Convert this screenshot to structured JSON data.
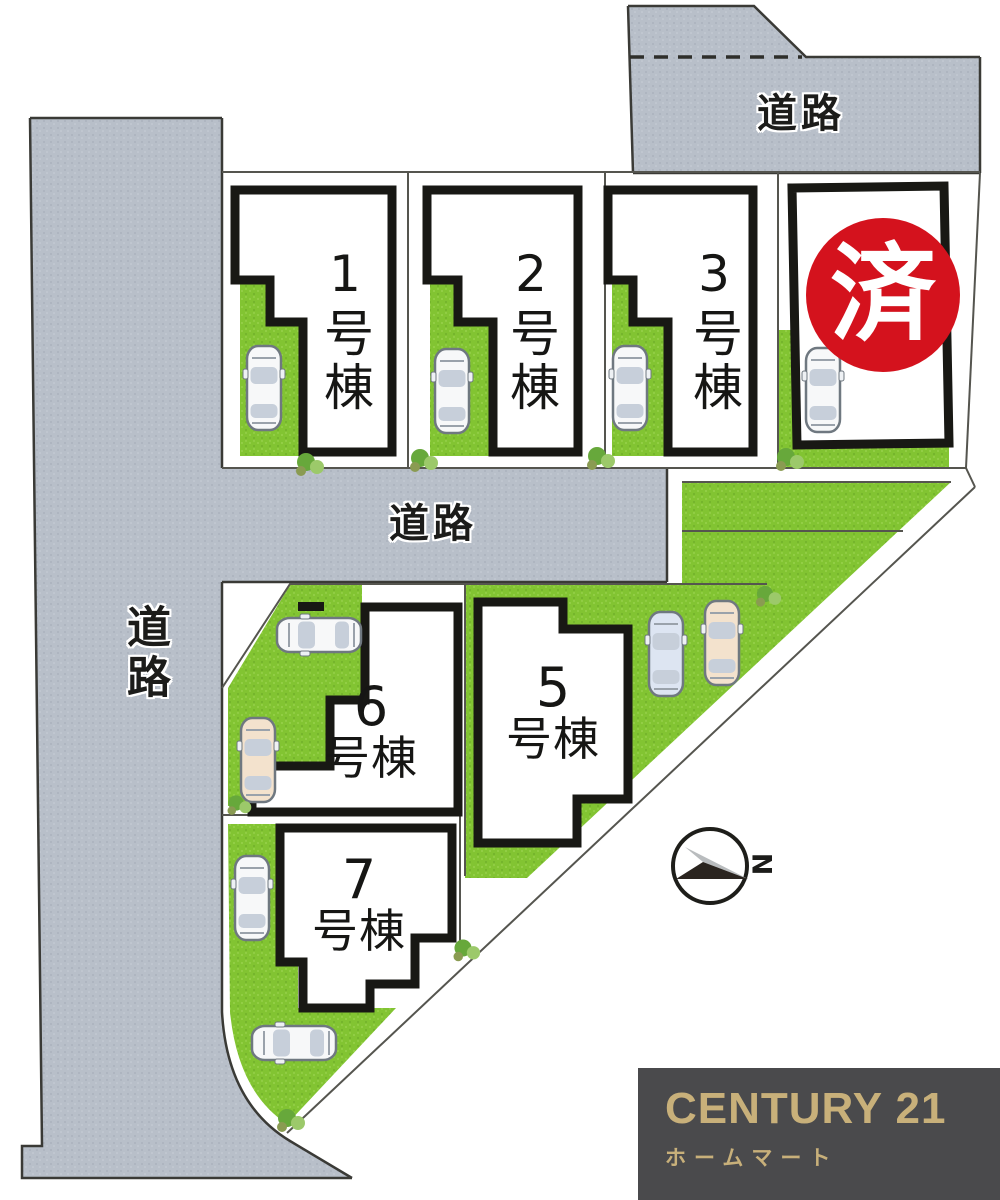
{
  "map": {
    "title_hint": "residential lot layout plan",
    "road_labels": {
      "top": "道路",
      "middle": "道路",
      "left": "道路"
    },
    "lots": [
      {
        "id": "lot-1",
        "label": "1号棟",
        "num": "1",
        "suffix": "号棟",
        "sold": false
      },
      {
        "id": "lot-2",
        "label": "2号棟",
        "num": "2",
        "suffix": "号棟",
        "sold": false
      },
      {
        "id": "lot-3",
        "label": "3号棟",
        "num": "3",
        "suffix": "号棟",
        "sold": false
      },
      {
        "id": "lot-4",
        "label": "",
        "sold": true,
        "note": "label hidden behind sold stamp"
      },
      {
        "id": "lot-5",
        "label": "5号棟",
        "num": "5",
        "suffix": "号棟",
        "sold": false
      },
      {
        "id": "lot-6",
        "label": "6号棟",
        "num": "6",
        "suffix": "号棟",
        "sold": false
      },
      {
        "id": "lot-7",
        "label": "7号棟",
        "num": "7",
        "suffix": "号棟",
        "sold": false
      }
    ],
    "sold_stamp": "済",
    "compass_label": "N",
    "colors": {
      "road_gray": "#b8bfc9",
      "grass_green": "#82c432",
      "house_outline": "#181814",
      "stamp_red": "#d4121d",
      "boundary_line": "#55554f"
    }
  },
  "branding": {
    "title": "CENTURY 21",
    "subtitle": "ホームマート",
    "text_color": "#c8b07a",
    "background": "#4a4a4c"
  }
}
